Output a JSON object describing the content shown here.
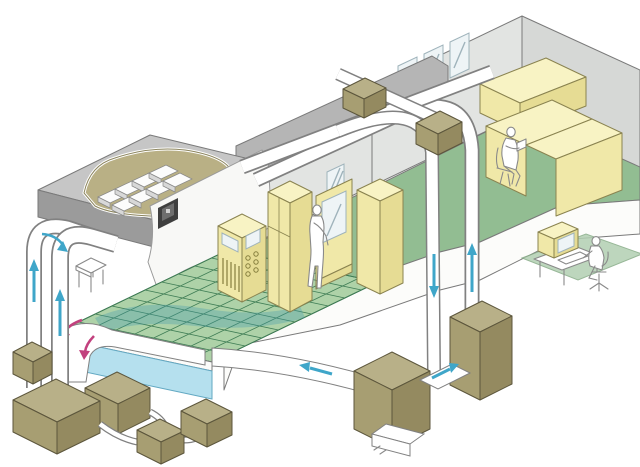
{
  "figure": {
    "kind": "isometric-cutaway-diagram",
    "subject": "cleanroom-and-office-hvac-airflow-system",
    "visible_text": []
  },
  "palette": {
    "bg": "#ffffff",
    "outline": "#7a7a7a",
    "roof_top": "#c6c6c6",
    "roof_front": "#9b9b9b",
    "roof_side": "#aeaeae",
    "slab_gray": "#b5b5b5",
    "wall_light": "#e2e4e2",
    "wall_gray": "#d6d8d6",
    "wall_white": "#f8f8f6",
    "floor_green": "#92bd92",
    "grid_green": "#aed2a8",
    "grid_line": "#3f7d55",
    "floor_wash": "#3f98ae",
    "plenum_blue": "#b5e0ee",
    "plenum_edge": "#62a8c2",
    "platform_white": "#fcfcfa",
    "duct_white": "#ffffff",
    "duct_outline": "#818181",
    "khaki_top": "#b8b088",
    "khaki_left": "#a79e72",
    "khaki_right": "#948a60",
    "khaki_edge": "#5c563c",
    "yellow_top": "#f8f3c4",
    "yellow_left": "#f0e8a8",
    "yellow_right": "#e6dc94",
    "yellow_edge": "#8a8350",
    "window": "#eef4f6",
    "window_edge": "#9fb3bb",
    "arrow_teal": "#3fa6c9",
    "arrow_pink": "#c2417e",
    "sketch": "#8a8a8a",
    "panel_dark": "#3f3f3f",
    "mat_green": "#b2cfb2",
    "mat_edge": "#86ab86"
  },
  "raised_floor_grid": {
    "cells_along_length": 10,
    "cells_along_depth": 8
  },
  "hepa_filters": {
    "rows": 2,
    "columns": 4
  },
  "airflow_arrows": [
    {
      "id": "left-riser-outer-up",
      "color": "teal",
      "direction": "up"
    },
    {
      "id": "left-riser-inner-up",
      "color": "teal",
      "direction": "up"
    },
    {
      "id": "left-bend-into-ceiling",
      "color": "teal",
      "direction": "curved-right"
    },
    {
      "id": "underfloor-exit-1",
      "color": "pink",
      "direction": "curved-down-left"
    },
    {
      "id": "underfloor-exit-2",
      "color": "pink",
      "direction": "curved-down"
    },
    {
      "id": "right-riser-supply-down",
      "color": "teal",
      "direction": "down"
    },
    {
      "id": "right-riser-return-up",
      "color": "teal",
      "direction": "up"
    },
    {
      "id": "unit-link-duct-right",
      "color": "teal",
      "direction": "right"
    },
    {
      "id": "return-trench-left",
      "color": "teal",
      "direction": "left"
    }
  ],
  "components": {
    "rooms": [
      "cleanroom-with-raised-floor",
      "machine-room",
      "office"
    ],
    "people": [
      "operator-standing-machine-room",
      "worker-seated-office",
      "operator-at-monitoring-computer"
    ],
    "equipment_boxes_ground": 7,
    "duct_mounted_boxes": 2,
    "windows_office_wall": 3,
    "wall_vents_machine_room": 2
  }
}
